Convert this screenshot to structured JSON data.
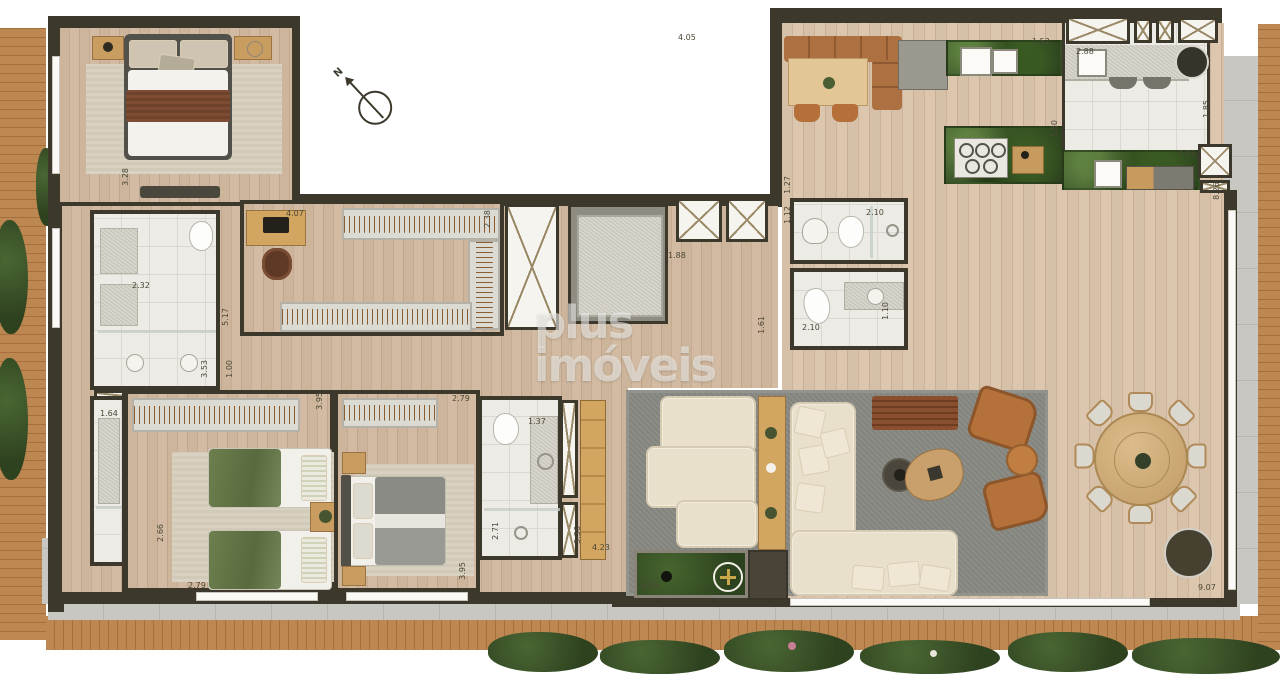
{
  "watermark": {
    "text": "plus imóveis"
  },
  "compass": {
    "label": "N"
  },
  "plus_marker": {
    "symbol": "+"
  },
  "colors": {
    "wall": "#3c392c",
    "wood_floor": "#cbb297",
    "deck_wood": "#b9834f",
    "bathroom_tile": "#edebe6",
    "terrace_tile": "#c9c7c2",
    "living_rug": "#8a8a84",
    "planter_grass": "#3f5a2e",
    "kitchen_counter_green": "#3f5a35",
    "sofa_cream": "#e9e0cc",
    "leather_brown": "#ad7040",
    "accent_gold": "#c8a84b"
  },
  "dimensions": [
    {
      "value": "4.05",
      "x": 678,
      "y": 34,
      "o": "h"
    },
    {
      "value": "3.28",
      "x": 122,
      "y": 168,
      "o": "v"
    },
    {
      "value": "2.32",
      "x": 132,
      "y": 282,
      "o": "h"
    },
    {
      "value": "5.17",
      "x": 222,
      "y": 308,
      "o": "v"
    },
    {
      "value": "3.53",
      "x": 201,
      "y": 360,
      "o": "v"
    },
    {
      "value": "1.00",
      "x": 226,
      "y": 360,
      "o": "v"
    },
    {
      "value": "4.07",
      "x": 286,
      "y": 210,
      "o": "h"
    },
    {
      "value": "2.38",
      "x": 484,
      "y": 210,
      "o": "v"
    },
    {
      "value": "1.88",
      "x": 668,
      "y": 252,
      "o": "h"
    },
    {
      "value": "1.61",
      "x": 758,
      "y": 316,
      "o": "v"
    },
    {
      "value": "1.27",
      "x": 784,
      "y": 176,
      "o": "v"
    },
    {
      "value": "1.12",
      "x": 784,
      "y": 206,
      "o": "v"
    },
    {
      "value": "2.10",
      "x": 866,
      "y": 209,
      "o": "h"
    },
    {
      "value": "2.10",
      "x": 802,
      "y": 324,
      "o": "h"
    },
    {
      "value": "1.10",
      "x": 882,
      "y": 302,
      "o": "v"
    },
    {
      "value": "1.52",
      "x": 1032,
      "y": 38,
      "o": "h"
    },
    {
      "value": "2.88",
      "x": 1076,
      "y": 48,
      "o": "h"
    },
    {
      "value": "1.50",
      "x": 1051,
      "y": 120,
      "o": "v"
    },
    {
      "value": "1.85",
      "x": 1203,
      "y": 100,
      "o": "v"
    },
    {
      "value": "2.53",
      "x": 1178,
      "y": 150,
      "o": "h"
    },
    {
      "value": "8.26",
      "x": 1213,
      "y": 182,
      "o": "v"
    },
    {
      "value": "1.64",
      "x": 100,
      "y": 410,
      "o": "h"
    },
    {
      "value": "2.66",
      "x": 157,
      "y": 524,
      "o": "v"
    },
    {
      "value": "2.79",
      "x": 188,
      "y": 582,
      "o": "h"
    },
    {
      "value": "3.95",
      "x": 316,
      "y": 392,
      "o": "v"
    },
    {
      "value": "2.79",
      "x": 452,
      "y": 395,
      "o": "h"
    },
    {
      "value": "3.95",
      "x": 459,
      "y": 562,
      "o": "v"
    },
    {
      "value": "1.37",
      "x": 528,
      "y": 418,
      "o": "h"
    },
    {
      "value": "2.71",
      "x": 492,
      "y": 522,
      "o": "v"
    },
    {
      "value": "3.36",
      "x": 574,
      "y": 526,
      "o": "v"
    },
    {
      "value": "4.23",
      "x": 592,
      "y": 544,
      "o": "h"
    },
    {
      "value": "6.06",
      "x": 641,
      "y": 582,
      "o": "h"
    },
    {
      "value": "9.07",
      "x": 1198,
      "y": 584,
      "o": "h"
    }
  ]
}
